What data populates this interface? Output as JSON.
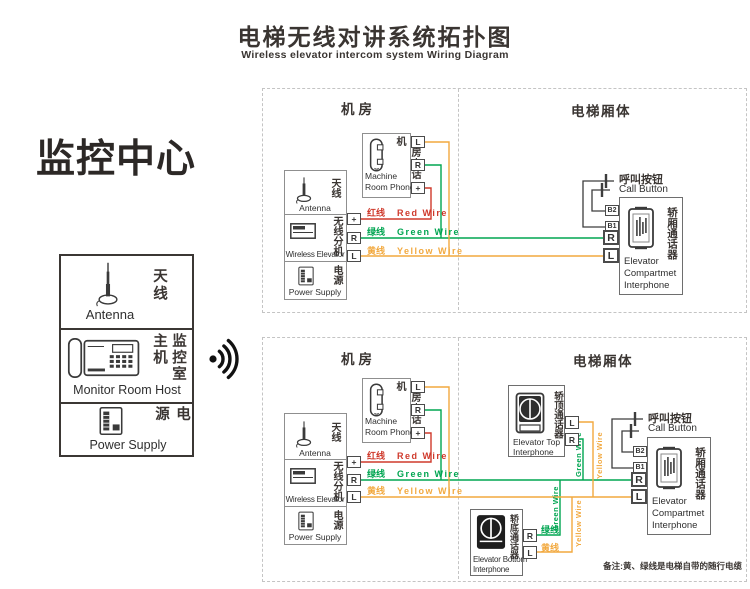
{
  "title": {
    "zh": "电梯无线对讲系统拓扑图",
    "en": "Wireless elevator intercom system Wiring Diagram"
  },
  "monitor_center": {
    "heading": "监控中心",
    "antenna": {
      "zh": "天线",
      "en": "Antenna"
    },
    "host": {
      "zh": "监控室主机",
      "en": "Monitor Room Host"
    },
    "power": {
      "zh": "电源",
      "en": "Power Supply"
    }
  },
  "sections": {
    "machine_room_header": "机房",
    "elevator_car_header": "电梯厢体"
  },
  "machine_room_phone": {
    "zh": "机房电话机",
    "en1": "Machine",
    "en2": "Room Phone"
  },
  "wireless_unit": {
    "antenna": {
      "zh": "天线",
      "en": "Antenna"
    },
    "wireless": {
      "zh": "无线分机",
      "en": "Wireless Elevator"
    },
    "power": {
      "zh": "电源",
      "en": "Power Supply"
    }
  },
  "wire_labels": {
    "red": {
      "zh": "红线",
      "en": "Red Wire"
    },
    "green": {
      "zh": "绿线",
      "en": "Green Wire"
    },
    "yellow": {
      "zh": "黄线",
      "en": "Yellow Wire"
    }
  },
  "vertical_wire_labels": {
    "green": "Green Wire",
    "yellow": "Yellow Wire"
  },
  "call_button": {
    "zh": "呼叫按钮",
    "en": "Call Button"
  },
  "compartment_interphone": {
    "zh": "轿厢通话器",
    "en1": "Elevator",
    "en2": "Compartmet",
    "en3": "Interphone"
  },
  "top_interphone": {
    "zh": "轿顶通话器",
    "en1": "Elevator Top",
    "en2": "Interphone"
  },
  "bottom_interphone": {
    "zh": "轿底通话器",
    "en1": "Elevator Bottom",
    "en2": "Interphone",
    "green_zh": "绿线",
    "yellow_zh": "黄线"
  },
  "terminals": {
    "L": "L",
    "R": "R",
    "plus": "+",
    "B1": "B1",
    "B2": "B2"
  },
  "note": "备注:黄、绿线是电梯自带的随行电缆",
  "colors": {
    "red_wire": "#cf3a2c",
    "green_wire": "#00a551",
    "yellow_wire": "#f2a93f",
    "diagram_line": "#3d3d3d",
    "text": "#3a3532",
    "box_border": "#8f8f8f",
    "dash_border": "#c4c4c4"
  }
}
